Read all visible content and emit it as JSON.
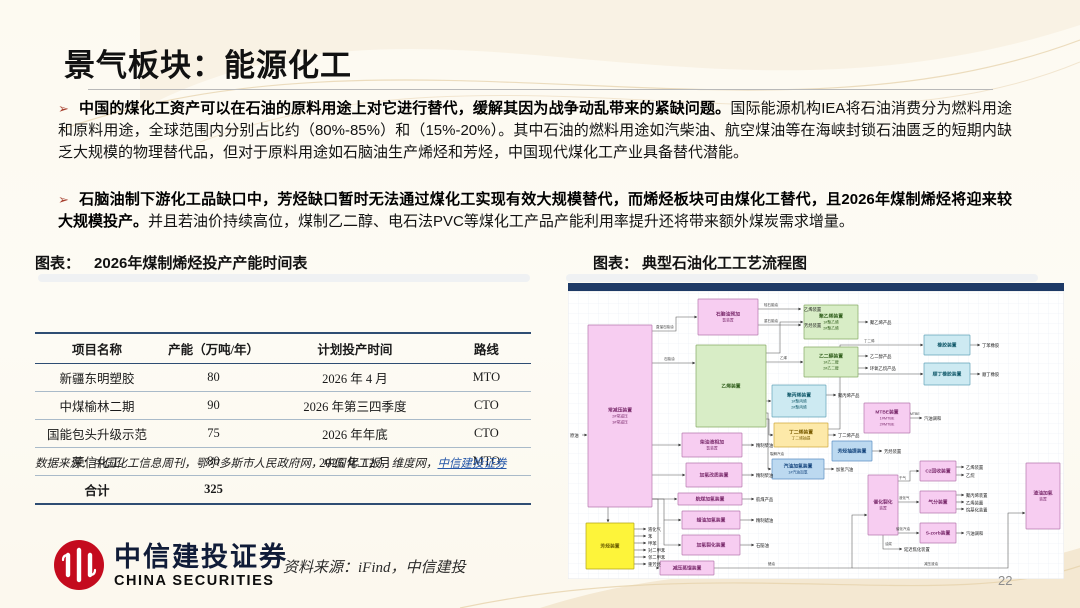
{
  "slide": {
    "title": "景气板块：能源化工",
    "page_number": "22",
    "bullets": [
      {
        "marker": "➢",
        "bold": "中国的煤化工资产可以在石油的原料用途上对它进行替代，缓解其因为战争动乱带来的紧缺问题。",
        "rest": "国际能源机构IEA将石油消费分为燃料用途和原料用途，全球范围内分别占比约（80%-85%）和（15%-20%）。其中石油的燃料用途如汽柴油、航空煤油等在海峡封锁石油匮乏的短期内缺乏大规模的物理替代品，但对于原料用途如石脑油生产烯烃和芳烃，中国现代煤化工产业具备替代潜能。"
      },
      {
        "marker": "➢",
        "bold": "石脑油制下游化工品缺口中，芳烃缺口暂时无法通过煤化工实现有效大规模替代，而烯烃板块可由煤化工替代，且2026年煤制烯烃将迎来较大规模投产。",
        "rest": "并且若油价持续高位，煤制乙二醇、电石法PVC等煤化工产品产能利用率提升还将带来额外煤炭需求增量。"
      }
    ],
    "figures": {
      "left_caption_prefix": "图表：",
      "left_caption": "2026年煤制烯烃投产产能时间表",
      "right_caption_prefix": "图表：",
      "right_caption": "典型石油化工工艺流程图"
    },
    "table": {
      "columns": [
        "项目名称",
        "产能（万吨/年）",
        "计划投产时间",
        "路线"
      ],
      "rows": [
        [
          "新疆东明塑胶",
          "80",
          "2026 年 4 月",
          "MTO"
        ],
        [
          "中煤榆林二期",
          "90",
          "2026 年第三四季度",
          "CTO"
        ],
        [
          "国能包头升级示范",
          "75",
          "2026 年年底",
          "CTO"
        ],
        [
          "荣信化工",
          "80",
          "2026 年 12 月",
          "MTO"
        ]
      ],
      "total_row": [
        "合计",
        "325"
      ],
      "source_prefix": "数据来源：中国化工信息周刊，鄂尔多斯市人民政府网，中国化工报，维度网，",
      "source_link": "中信建投证券"
    },
    "footer": {
      "brand_cn": "中信建投证券",
      "brand_en": "CHINA SECURITIES",
      "source": "资料来源：iFind，中信建投"
    },
    "colors": {
      "brand_red": "#c40b1e",
      "bullet_red": "#a63f2e",
      "table_rule_navy": "#2e4d73",
      "link_blue": "#2456a8",
      "diagram_bar_navy": "#1e3a66"
    }
  },
  "diagram": {
    "bar_color": "#1e3a66",
    "palette": {
      "pink": {
        "f": "#f7cdf1",
        "s": "#b578ad",
        "t": "#7c2d6e"
      },
      "green": {
        "f": "#d8edc6",
        "s": "#85a964",
        "t": "#33611f"
      },
      "cyan": {
        "f": "#cdeaf2",
        "s": "#62a3b8",
        "t": "#125a6b"
      },
      "blue": {
        "f": "#bcd9f0",
        "s": "#5b8fc4",
        "t": "#16467e"
      },
      "yellow": {
        "f": "#fdf43a",
        "s": "#b3a51a",
        "t": "#6b5d00"
      },
      "lightyellow": {
        "f": "#fde9a9",
        "s": "#cfa93c",
        "t": "#7a5c00"
      }
    },
    "nodes": [
      {
        "name": "atmospheric-vacuum-unit",
        "r": [
          20,
          42,
          64,
          182
        ],
        "c": "pink",
        "lines": [
          "常减压装置",
          "2#常减压",
          "3#常减压"
        ]
      },
      {
        "name": "naphtha-prehydro-unit",
        "r": [
          130,
          16,
          60,
          36
        ],
        "c": "pink",
        "lines": [
          "石脑油预加",
          "氢装置"
        ]
      },
      {
        "name": "ethylene-unit",
        "r": [
          128,
          62,
          70,
          82
        ],
        "c": "green",
        "lines": [
          "乙烯装置"
        ]
      },
      {
        "name": "diesel-hydro-unit",
        "r": [
          114,
          150,
          60,
          24
        ],
        "c": "pink",
        "lines": [
          "柴油液相加",
          "氢装置"
        ]
      },
      {
        "name": "hydro-upgrading-unit",
        "r": [
          118,
          180,
          56,
          24
        ],
        "c": "pink",
        "lines": [
          "加氢改质装置"
        ]
      },
      {
        "name": "jetfuel-hydro-unit",
        "r": [
          110,
          210,
          64,
          12
        ],
        "c": "pink",
        "lines": [
          "航煤加氢装置"
        ]
      },
      {
        "name": "waxoil-hydro-unit",
        "r": [
          114,
          228,
          58,
          18
        ],
        "c": "pink",
        "lines": [
          "蜡油加氢装置"
        ]
      },
      {
        "name": "hydrocracking-unit",
        "r": [
          114,
          252,
          58,
          20
        ],
        "c": "pink",
        "lines": [
          "加氢裂化装置"
        ]
      },
      {
        "name": "vacuum-distillation-unit",
        "r": [
          92,
          278,
          54,
          14
        ],
        "c": "pink",
        "lines": [
          "减压蒸馏装置"
        ]
      },
      {
        "name": "aromatics-unit",
        "r": [
          18,
          240,
          48,
          46
        ],
        "c": "yellow",
        "lines": [
          "芳烃装置"
        ]
      },
      {
        "name": "polyethylene-unit",
        "r": [
          236,
          22,
          54,
          34
        ],
        "c": "green",
        "lines": [
          "聚乙烯装置",
          "1#聚乙烯",
          "2#聚乙烯"
        ]
      },
      {
        "name": "meg-unit",
        "r": [
          236,
          64,
          54,
          30
        ],
        "c": "green",
        "lines": [
          "乙二醇装置",
          "1#乙二醇",
          "2#乙二醇"
        ]
      },
      {
        "name": "polypropylene-unit",
        "r": [
          204,
          102,
          54,
          32
        ],
        "c": "cyan",
        "lines": [
          "聚丙烯装置",
          "1#聚丙烯",
          "2#聚丙烯"
        ]
      },
      {
        "name": "butadiene-unit",
        "r": [
          206,
          140,
          54,
          24
        ],
        "c": "lightyellow",
        "lines": [
          "丁二烯装置",
          "丁二烯抽提"
        ]
      },
      {
        "name": "pygas-hydro-unit",
        "r": [
          204,
          176,
          52,
          20
        ],
        "c": "blue",
        "lines": [
          "汽油加氢装置",
          "1#汽油加氢"
        ]
      },
      {
        "name": "rubber-unit",
        "r": [
          356,
          52,
          46,
          20
        ],
        "c": "cyan",
        "lines": [
          "橡胶装置"
        ]
      },
      {
        "name": "cis-rubber-unit",
        "r": [
          356,
          80,
          46,
          22
        ],
        "c": "cyan",
        "lines": [
          "顺丁橡胶装置"
        ]
      },
      {
        "name": "mtbe-unit",
        "r": [
          296,
          120,
          46,
          30
        ],
        "c": "pink",
        "lines": [
          "MTBE装置",
          "1#MTBE",
          "2#MTBE"
        ]
      },
      {
        "name": "aromatics-extraction-unit",
        "r": [
          264,
          158,
          40,
          20
        ],
        "c": "blue",
        "lines": [
          "芳烃抽提装置"
        ]
      },
      {
        "name": "fcc-unit",
        "r": [
          300,
          192,
          30,
          60
        ],
        "c": "pink",
        "lines": [
          "催化裂化",
          "装置"
        ]
      },
      {
        "name": "c2-recovery-unit",
        "r": [
          352,
          178,
          36,
          20
        ],
        "c": "pink",
        "lines": [
          "C2回收装置"
        ]
      },
      {
        "name": "gas-fractionation-unit",
        "r": [
          352,
          208,
          36,
          22
        ],
        "c": "pink",
        "lines": [
          "气分装置"
        ]
      },
      {
        "name": "s-zorb-unit",
        "r": [
          352,
          240,
          36,
          20
        ],
        "c": "pink",
        "lines": [
          "S-zorb装置"
        ]
      },
      {
        "name": "residue-hydro-unit",
        "r": [
          458,
          180,
          34,
          66
        ],
        "c": "pink",
        "lines": [
          "渣油加氢",
          "装置"
        ]
      }
    ],
    "edges": [
      {
        "p": [
          14,
          152,
          19,
          152
        ]
      },
      {
        "p": [
          84,
          48,
          108,
          48,
          108,
          34,
          129,
          34
        ]
      },
      {
        "p": [
          84,
          80,
          127,
          80
        ]
      },
      {
        "p": [
          84,
          162,
          113,
          162
        ]
      },
      {
        "p": [
          84,
          192,
          117,
          192
        ]
      },
      {
        "p": [
          84,
          216,
          109,
          216
        ]
      },
      {
        "p": [
          84,
          216,
          96,
          216,
          96,
          237,
          113,
          237
        ]
      },
      {
        "p": [
          96,
          237,
          96,
          262,
          113,
          262
        ]
      },
      {
        "p": [
          84,
          216,
          90,
          216,
          90,
          285,
          91,
          285
        ]
      },
      {
        "p": [
          40,
          224,
          40,
          239
        ]
      },
      {
        "p": [
          190,
          26,
          233,
          26
        ]
      },
      {
        "p": [
          190,
          42,
          233,
          42
        ]
      },
      {
        "p": [
          198,
          70,
          212,
          70,
          212,
          39,
          235,
          39
        ]
      },
      {
        "p": [
          198,
          79,
          235,
          79
        ]
      },
      {
        "p": [
          198,
          118,
          203,
          118
        ]
      },
      {
        "p": [
          198,
          136,
          201,
          136,
          201,
          152,
          205,
          152
        ]
      },
      {
        "p": [
          198,
          130,
          200,
          130,
          200,
          186,
          203,
          186
        ]
      },
      {
        "p": [
          290,
          39,
          300,
          39
        ]
      },
      {
        "p": [
          290,
          73,
          300,
          73
        ]
      },
      {
        "p": [
          290,
          85,
          300,
          85
        ]
      },
      {
        "p": [
          258,
          112,
          268,
          112
        ]
      },
      {
        "p": [
          260,
          152,
          268,
          152
        ]
      },
      {
        "p": [
          260,
          146,
          272,
          146,
          272,
          62,
          355,
          62
        ]
      },
      {
        "p": [
          272,
          91,
          355,
          91
        ]
      },
      {
        "p": [
          402,
          62,
          412,
          62
        ]
      },
      {
        "p": [
          402,
          91,
          412,
          91
        ]
      },
      {
        "p": [
          256,
          186,
          266,
          186
        ]
      },
      {
        "p": [
          342,
          135,
          354,
          135
        ]
      },
      {
        "p": [
          304,
          168,
          314,
          168
        ]
      },
      {
        "p": [
          146,
          285,
          284,
          285,
          284,
          232,
          299,
          232
        ]
      },
      {
        "p": [
          284,
          285,
          440,
          285,
          440,
          230,
          457,
          230
        ]
      },
      {
        "p": [
          330,
          198,
          342,
          198,
          342,
          188,
          351,
          188
        ]
      },
      {
        "p": [
          330,
          219,
          351,
          219
        ]
      },
      {
        "p": [
          330,
          250,
          351,
          250
        ]
      },
      {
        "p": [
          315,
          252,
          315,
          266,
          334,
          266
        ]
      },
      {
        "p": [
          388,
          184,
          396,
          184
        ]
      },
      {
        "p": [
          388,
          192,
          396,
          192
        ]
      },
      {
        "p": [
          388,
          212,
          396,
          212
        ]
      },
      {
        "p": [
          388,
          219,
          396,
          219
        ]
      },
      {
        "p": [
          388,
          226,
          396,
          226
        ]
      },
      {
        "p": [
          388,
          250,
          396,
          250
        ]
      },
      {
        "p": [
          174,
          162,
          186,
          162
        ]
      },
      {
        "p": [
          174,
          192,
          186,
          192
        ]
      },
      {
        "p": [
          174,
          216,
          186,
          216
        ]
      },
      {
        "p": [
          172,
          237,
          186,
          237
        ]
      },
      {
        "p": [
          172,
          262,
          186,
          262
        ]
      },
      {
        "p": [
          66,
          246,
          78,
          246
        ]
      },
      {
        "p": [
          66,
          253,
          78,
          253
        ]
      },
      {
        "p": [
          66,
          260,
          78,
          260
        ]
      },
      {
        "p": [
          66,
          267,
          78,
          267
        ]
      },
      {
        "p": [
          66,
          274,
          78,
          274
        ]
      },
      {
        "p": [
          66,
          281,
          78,
          281
        ]
      }
    ],
    "texts": [
      {
        "t": "原油",
        "x": 2,
        "y": 154
      },
      {
        "t": "乙烯装置",
        "x": 236,
        "y": 28
      },
      {
        "t": "芳烃装置",
        "x": 236,
        "y": 44
      },
      {
        "t": "聚乙烯产品",
        "x": 302,
        "y": 41
      },
      {
        "t": "乙二醇产品",
        "x": 302,
        "y": 75
      },
      {
        "t": "环氧乙烷产品",
        "x": 302,
        "y": 87
      },
      {
        "t": "聚丙烯产品",
        "x": 270,
        "y": 114
      },
      {
        "t": "丁二烯产品",
        "x": 270,
        "y": 154
      },
      {
        "t": "丁苯橡胶",
        "x": 414,
        "y": 64
      },
      {
        "t": "顺丁橡胶",
        "x": 414,
        "y": 93
      },
      {
        "t": "加氢汽油",
        "x": 268,
        "y": 188
      },
      {
        "t": "汽油调和",
        "x": 356,
        "y": 137
      },
      {
        "t": "芳烃装置",
        "x": 316,
        "y": 170
      },
      {
        "t": "乙烯装置",
        "x": 398,
        "y": 186
      },
      {
        "t": "乙烷",
        "x": 398,
        "y": 194
      },
      {
        "t": "聚丙烯装置",
        "x": 398,
        "y": 214
      },
      {
        "t": "乙烯装置",
        "x": 398,
        "y": 221.5
      },
      {
        "t": "烷基化装置",
        "x": 398,
        "y": 228.5
      },
      {
        "t": "汽油调和",
        "x": 398,
        "y": 252
      },
      {
        "t": "延迟焦化装置",
        "x": 336,
        "y": 268
      },
      {
        "t": "精制柴油",
        "x": 188,
        "y": 164
      },
      {
        "t": "精制柴油",
        "x": 188,
        "y": 194
      },
      {
        "t": "航煤产品",
        "x": 188,
        "y": 218
      },
      {
        "t": "精制蜡油",
        "x": 188,
        "y": 239
      },
      {
        "t": "石脑油",
        "x": 188,
        "y": 264
      },
      {
        "t": "液化气",
        "x": 80,
        "y": 248
      },
      {
        "t": "苯",
        "x": 80,
        "y": 255
      },
      {
        "t": "甲苯",
        "x": 80,
        "y": 262
      },
      {
        "t": "对二甲苯",
        "x": 80,
        "y": 269
      },
      {
        "t": "邻二甲苯",
        "x": 80,
        "y": 276
      },
      {
        "t": "重芳烃",
        "x": 80,
        "y": 283
      }
    ],
    "edge_labels": [
      {
        "t": "直馏石脑油",
        "x": 88,
        "y": 45
      },
      {
        "t": "石脑油",
        "x": 96,
        "y": 77
      },
      {
        "t": "轻石脑油",
        "x": 196,
        "y": 23
      },
      {
        "t": "重石脑油",
        "x": 196,
        "y": 39
      },
      {
        "t": "乙烯",
        "x": 212,
        "y": 76
      },
      {
        "t": "裂解汽油",
        "x": 202,
        "y": 172
      },
      {
        "t": "丁二烯",
        "x": 296,
        "y": 59
      },
      {
        "t": "蜡油",
        "x": 200,
        "y": 282
      },
      {
        "t": "减压渣油",
        "x": 356,
        "y": 282
      },
      {
        "t": "干气",
        "x": 331,
        "y": 196
      },
      {
        "t": "液化气",
        "x": 331,
        "y": 216
      },
      {
        "t": "催化汽油",
        "x": 328,
        "y": 247
      },
      {
        "t": "油浆",
        "x": 317,
        "y": 262
      },
      {
        "t": "MTBE",
        "x": 342,
        "y": 132
      }
    ]
  }
}
